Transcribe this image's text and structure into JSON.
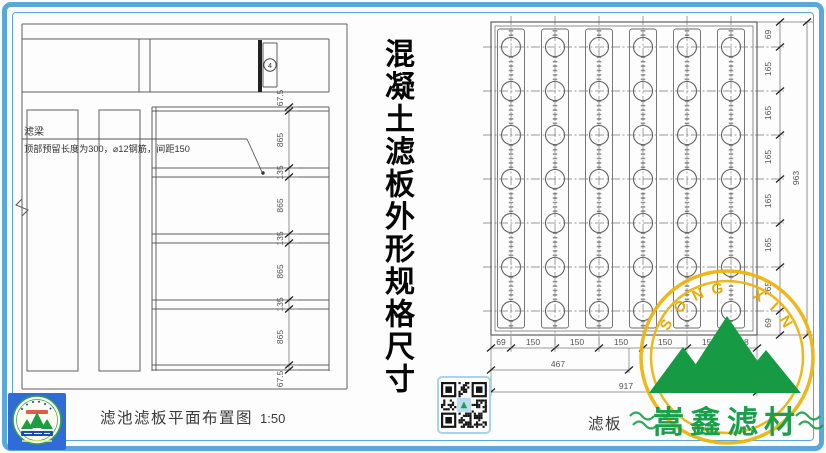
{
  "frame": {
    "color": "#58a8dd"
  },
  "center_title": "混凝土滤板外形规格尺寸",
  "left_drawing": {
    "beam_label": "滤梁",
    "note": "顶部预留长度为300，⌀12钢筋，间距150",
    "marker": "4",
    "title": "滤池滤板平面布置图",
    "scale": "1:50",
    "dims": [
      "67.5",
      "865",
      "135",
      "865",
      "135",
      "865",
      "135",
      "865",
      "67.5"
    ]
  },
  "right_drawing": {
    "title_visible": "滤板",
    "grid": {
      "rows": 7,
      "cols": 6
    },
    "side_dims": [
      "69",
      "165",
      "165",
      "165",
      "165",
      "165",
      "165",
      "69"
    ],
    "side_total": "963",
    "bottom_dims": [
      "69",
      "150",
      "150",
      "150",
      "150",
      "150",
      "98"
    ],
    "bottom_sub": "467",
    "bottom_total": "917"
  },
  "watermark": {
    "arc_text": "SONG XIN",
    "company": "嵩鑫滤材",
    "ring_color": "#eeb40e",
    "green": "#18a14a"
  }
}
